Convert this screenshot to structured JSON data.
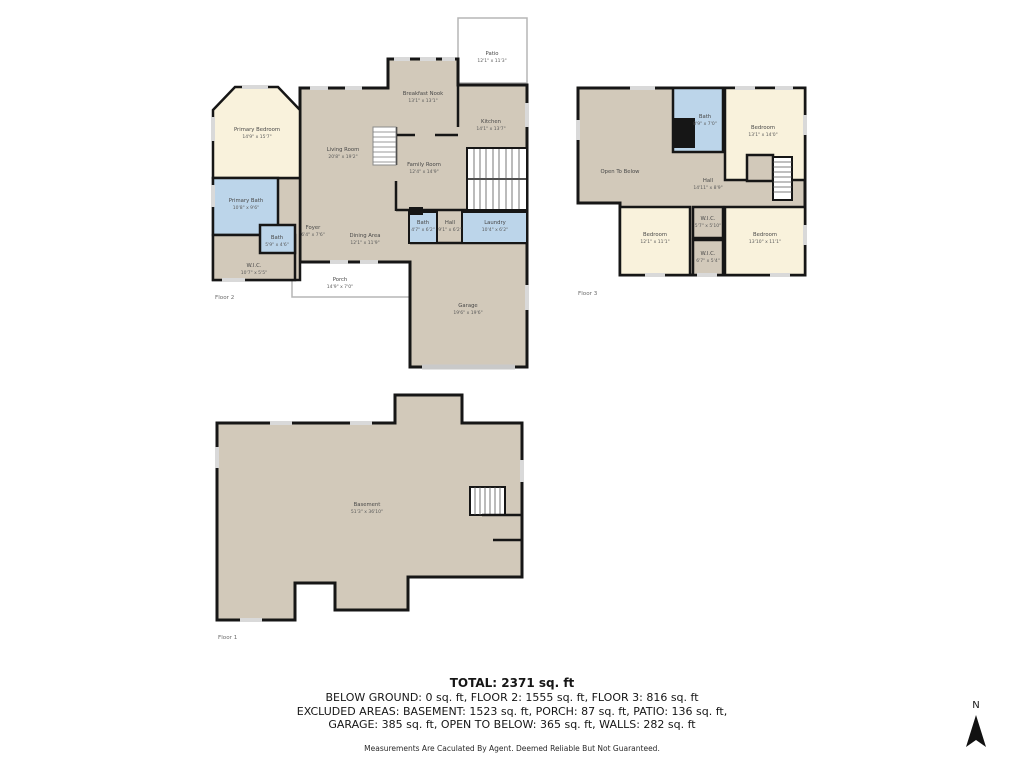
{
  "colors": {
    "wall": "#161616",
    "floor_tan": "#d2c9ba",
    "bedroom_cream": "#f9f2dc",
    "bath_blue": "#bcd5ea",
    "window_gray": "#d9d9d9",
    "outdoor_stroke": "#b5b5b5"
  },
  "floor2": {
    "label": "Floor 2",
    "rooms": {
      "patio": {
        "name": "Patio",
        "dims": "12'1\" x 11'3\""
      },
      "breakfast_nook": {
        "name": "Breakfast Nook",
        "dims": "13'1\" x 13'1\""
      },
      "kitchen": {
        "name": "Kitchen",
        "dims": "14'1\" x 13'7\""
      },
      "living_room": {
        "name": "Living Room",
        "dims": "20'8\" x 19'2\""
      },
      "family_room": {
        "name": "Family Room",
        "dims": "12'4\" x 14'9\""
      },
      "primary_bedroom": {
        "name": "Primary Bedroom",
        "dims": "14'9\" x 15'7\""
      },
      "primary_bath": {
        "name": "Primary Bath",
        "dims": "10'8\" x 9'6\""
      },
      "bath": {
        "name": "Bath",
        "dims": "5'9\" x 4'6\""
      },
      "wic": {
        "name": "W.I.C.",
        "dims": "10'7\" x 5'5\""
      },
      "foyer": {
        "name": "Foyer",
        "dims": "6'4\" x 7'6\""
      },
      "dining_area": {
        "name": "Dining Area",
        "dims": "12'1\" x 11'9\""
      },
      "bath2": {
        "name": "Bath",
        "dims": "4'7\" x 6'2\""
      },
      "hall": {
        "name": "Hall",
        "dims": "9'1\" x 6'2\""
      },
      "laundry": {
        "name": "Laundry",
        "dims": "10'4\" x 6'2\""
      },
      "porch": {
        "name": "Porch",
        "dims": "14'9\" x 7'0\""
      },
      "garage": {
        "name": "Garage",
        "dims": "19'6\" x 19'6\""
      }
    }
  },
  "floor3": {
    "label": "Floor 3",
    "rooms": {
      "open_to_below": {
        "name": "Open To Below"
      },
      "bath": {
        "name": "Bath",
        "dims": "8'9\" x 7'0\""
      },
      "bedroom1": {
        "name": "Bedroom",
        "dims": "13'1\" x 14'0\""
      },
      "hall": {
        "name": "Hall",
        "dims": "14'11\" x 8'9\""
      },
      "wic1": {
        "name": "W.I.C.",
        "dims": "5'7\" x 5'10\""
      },
      "bedroom2": {
        "name": "Bedroom",
        "dims": "12'1\" x 11'1\""
      },
      "wic2": {
        "name": "W.I.C.",
        "dims": "6'7\" x 5'4\""
      },
      "bedroom3": {
        "name": "Bedroom",
        "dims": "13'10\" x 11'1\""
      }
    }
  },
  "floor1": {
    "label": "Floor 1",
    "rooms": {
      "basement": {
        "name": "Basement",
        "dims": "51'3\" x 36'10\""
      }
    }
  },
  "summary": {
    "total": "TOTAL: 2371 sq. ft",
    "line1": "BELOW GROUND: 0 sq. ft, FLOOR 2: 1555 sq. ft, FLOOR 3: 816 sq. ft",
    "line2": "EXCLUDED AREAS: BASEMENT: 1523 sq. ft, PORCH: 87 sq. ft, PATIO: 136 sq. ft,",
    "line3": "GARAGE: 385 sq. ft, OPEN TO BELOW: 365 sq. ft, WALLS: 282 sq. ft",
    "disclaimer": "Measurements Are Caculated By Agent. Deemed Reliable But Not Guaranteed."
  },
  "compass": {
    "n": "N"
  }
}
